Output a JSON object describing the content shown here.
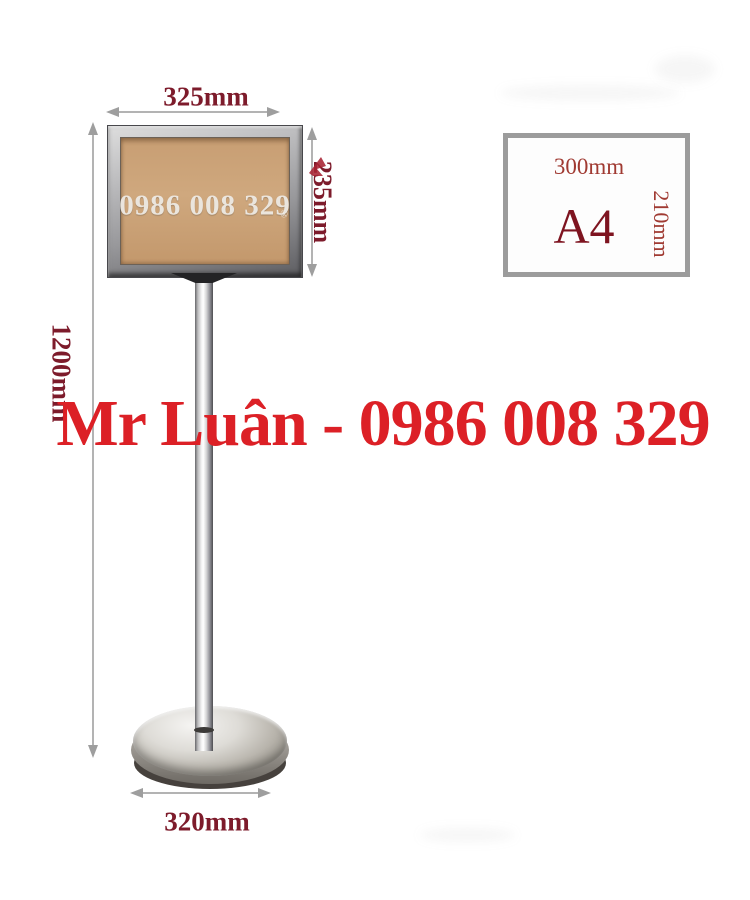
{
  "product_photo": {
    "dimensions": {
      "board_width": "325mm",
      "board_height": "235mm",
      "stand_height": "1200mm",
      "base_diameter": "320mm"
    },
    "a4_diagram": {
      "width_label": "300mm",
      "size_name": "A4",
      "height_label": "210mm"
    },
    "watermarks": {
      "board_phone": "0986 008 329",
      "registered_mark": "®",
      "contact_overlay": "Mr Luân - 0986 008 329"
    },
    "colors": {
      "dimension_text": "#7d1b2b",
      "contact_text": "#dc2026",
      "a4_label_text": "#a03a32",
      "a4_size_text": "#7e1420",
      "logo_mark_red": "#a82333",
      "chrome_gray": "#9c9c9c"
    }
  }
}
